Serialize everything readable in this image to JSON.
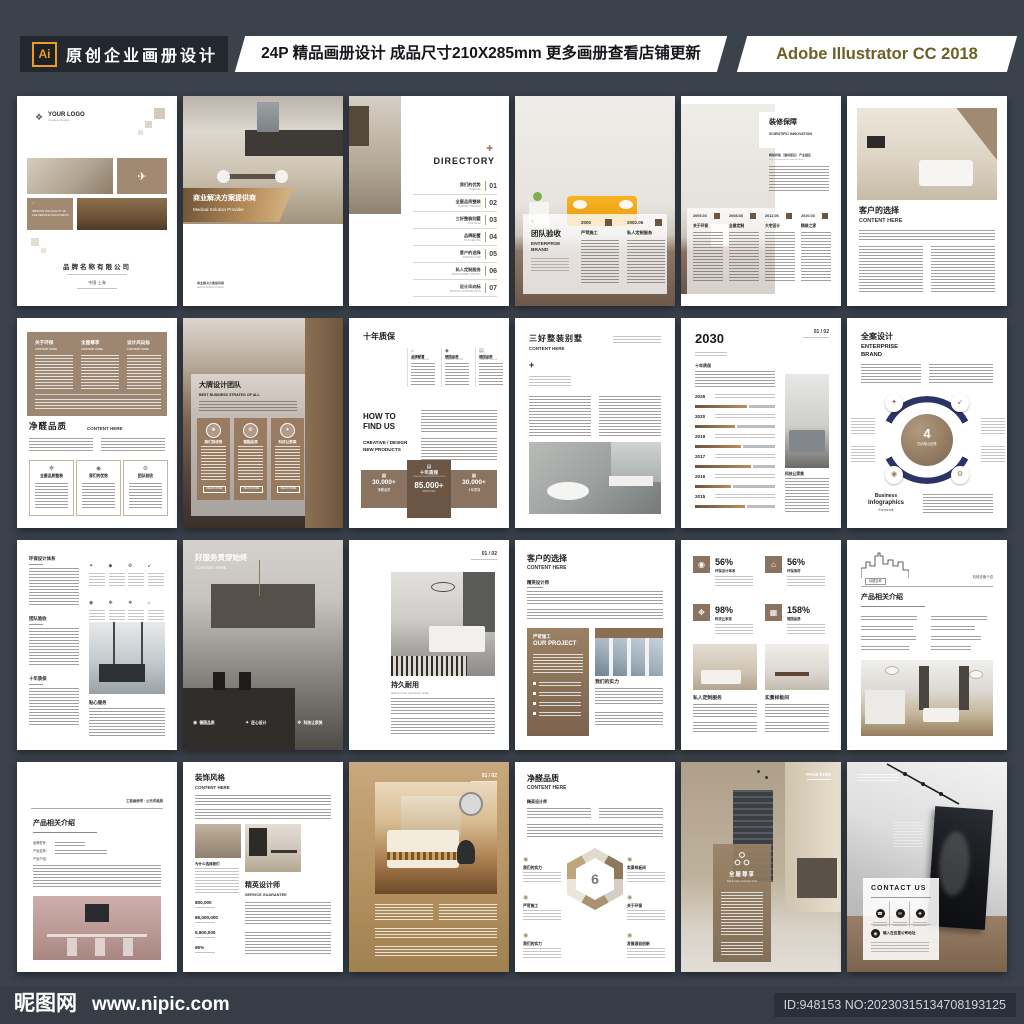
{
  "header": {
    "logo": "Ai",
    "title": "原创企业画册设计",
    "subtitle": "24P 精品画册设计 成品尺寸210X285mm 更多画册查看店铺更新",
    "software": "Adobe Illustrator CC 2018"
  },
  "footer": {
    "site": "昵图网",
    "url": "www.nipic.com",
    "id_text": "ID:948153 NO:20230315134708193125"
  },
  "colors": {
    "background": "#3b424c",
    "accent_orange": "#eb9c21",
    "taupe": "#9d8672",
    "brown": "#8a7360",
    "navy": "#2e3366"
  },
  "icons": {
    "paper_plane": "✈",
    "directory_plus": "✚",
    "plus": "+",
    "gear": "⚙",
    "arrow_in": "↙",
    "spark": "✦",
    "target": "◉",
    "tools": "✥",
    "diamond": "◆",
    "home": "⌂",
    "doc": "▤",
    "monitor": "▦",
    "phone": "☎",
    "mail": "✉",
    "marker": "❖",
    "circle": "◌"
  },
  "pages": [
    {
      "logo": "YOUR LOGO",
      "logo_sub": "Creative Design",
      "tagline": "IMPROVE THE QUALITY OF LIFE SERVICE FOR PATIENTS",
      "company": "品牌名称有限公司",
      "place": "中国·上海"
    },
    {
      "banner_cn": "商业解决方案提供商",
      "banner_en": "Medical Solution Provider",
      "note_cn": "商业解决方案提供商",
      "note_en": "Medical Solution Provider"
    },
    {
      "title": "DIRECTORY",
      "items": [
        {
          "cn": "我们的优势",
          "en": "PREFACE",
          "no": "01"
        },
        {
          "cn": "全屋品质整装",
          "en": "COMPANY PROFILE",
          "no": "02"
        },
        {
          "cn": "三好整装别墅",
          "en": "OUR TEAM",
          "no": "03"
        },
        {
          "cn": "品牌配置",
          "en": "OUR SERVICE",
          "no": "04"
        },
        {
          "cn": "客户的选择",
          "en": "SERVICE FLOW",
          "no": "05"
        },
        {
          "cn": "私人定制服务",
          "en": "DEVELOPMENT HISTORY",
          "no": "06"
        },
        {
          "cn": "设计风向标",
          "en": "PRODUCT INTRODUCTION",
          "no": "07"
        }
      ]
    },
    {
      "title_cn": "团队验收",
      "title_en": "ENTERPRSE BRAND",
      "milestones": [
        {
          "year": "2000",
          "label": "严苛施工"
        },
        {
          "year": "2002.05",
          "label": "私人定制服务"
        }
      ]
    },
    {
      "title_cn": "装修保障",
      "title_en": "SCIENTIFIC INNOVATION",
      "note_cn": "精装样板（通用版区）产业园区",
      "note_en": "High end Equipment Industrial Base",
      "milestones": [
        {
          "year": "2005.03",
          "label": "关于环保"
        },
        {
          "year": "2008.08",
          "label": "全屋定制"
        },
        {
          "year": "2012.06",
          "label": "大宅设计"
        },
        {
          "year": "2020.08",
          "label": "精装之家"
        }
      ]
    },
    {
      "title_cn": "客户的选择",
      "title_en": "CONTENT HERE"
    },
    {
      "cols": [
        {
          "cn": "关于环保",
          "en": "CONTENT HERE"
        },
        {
          "cn": "全屋尊享",
          "en": "CONTENT HERE"
        },
        {
          "cn": "设计风向标",
          "en": "CONTENT HERE"
        }
      ],
      "title_cn": "净醛品质",
      "title_en": "CONTENT HERE",
      "boxes": [
        "全屋品质整装",
        "我们的优势",
        "团队验收"
      ]
    },
    {
      "title_cn": "大牌设计团队",
      "title_en": "BEST BUSINESS STRATEG OF ALL",
      "cards": [
        "我们的优势",
        "德国品质",
        "科技让家美"
      ],
      "read_more": "READ MORE"
    },
    {
      "title": "十年质保",
      "cols": [
        "品牌配置",
        "德国品质",
        "德国品质"
      ],
      "col_sub": "CREATIVE / DESIGN",
      "how1": "HOW TO",
      "how2": "FIND US",
      "label1": "CREATIVE / DESIGN",
      "label2": "NEW PRODUCTS",
      "stat_left": {
        "value": "30.000+",
        "label": "净醛品质"
      },
      "stat_mid": {
        "title": "十年质保",
        "sub": "CREATIVE / DESIGN NEW PRODUCTS",
        "value": "85.000+",
        "unit": "SERVICES"
      },
      "stat_right": {
        "value": "30.000+",
        "label": "十年质保"
      }
    },
    {
      "title_cn": "三好整装别墅",
      "title_en": "CONTENT HERE",
      "plus": "+"
    },
    {
      "page_no": "01 / 02",
      "title": "2030",
      "sub": "十年质保",
      "years": [
        "2025",
        "2020",
        "2019",
        "2017",
        "2016",
        "2015"
      ],
      "side": "科技让家美"
    },
    {
      "title_cn": "全案设计",
      "title_en1": "ENTERPRISE",
      "title_en2": "BRAND",
      "num": "4",
      "num_label": "四大核心优势",
      "foot1": "Business",
      "foot2": "Infographics",
      "foot3": "· Elements ·"
    },
    {
      "sections": [
        "环保设计体系",
        "团队验收",
        "十年质保"
      ],
      "bottom": "贴心服务"
    },
    {
      "title_cn": "好服务贯穿始终",
      "title_en": "CONTENT HERE",
      "badges": [
        "德国品质",
        "匠心设计",
        "科技让家美"
      ]
    },
    {
      "page_no": "01 / 02",
      "title_cn": "持久耐用",
      "title_en": "Half an hour economic circle"
    },
    {
      "title_cn": "客户的选择",
      "title_en": "CONTENT HERE",
      "sub": "精英设计师",
      "card_cn": "严苛施工",
      "card_en": "OUR PROJECT",
      "strength": "我们的实力"
    },
    {
      "stats": [
        {
          "pct": "56%",
          "label": "环保设计体系"
        },
        {
          "pct": "56%",
          "label": "环保用材"
        },
        {
          "pct": "98%",
          "label": "科技让家美"
        },
        {
          "pct": "158%",
          "label": "德国品质"
        }
      ],
      "cols": [
        "私人定制服务",
        "实景样板间"
      ]
    },
    {
      "corner": "标题名称",
      "corner_right": "机械设备介绍",
      "title": "产品相关介绍"
    },
    {
      "corner": "工装画册带 · 公元风格展",
      "title": "产品相关介绍",
      "spec1": "品牌型号：",
      "spec2": "产品名称：",
      "spec3": "产品介绍："
    },
    {
      "title_cn": "装饰风格",
      "title_en": "CONTENT HERE",
      "why": "为什么选择我们",
      "stats": [
        "800,000",
        "86,000,000",
        "5,800,000",
        "95%"
      ],
      "title2_cn": "精英设计师",
      "title2_en": "SERVICE GUARANTEE"
    },
    {
      "page_no": "01 / 02"
    },
    {
      "title_cn": "净醛品质",
      "title_en": "CONTENT HERE",
      "sub": "精英设计师",
      "num": "6",
      "left": [
        "我们的实力",
        "严苛施工",
        "我们的实力"
      ],
      "right": [
        "实景样板间",
        "关于环保",
        "发展源自创新"
      ]
    },
    {
      "page_no": "PAGE 01/02",
      "panel_cn": "全屋尊享",
      "panel_en": "Half an hour economic circle"
    },
    {
      "contact": "CONTACT US",
      "address": "输入在这里公司地址"
    }
  ]
}
